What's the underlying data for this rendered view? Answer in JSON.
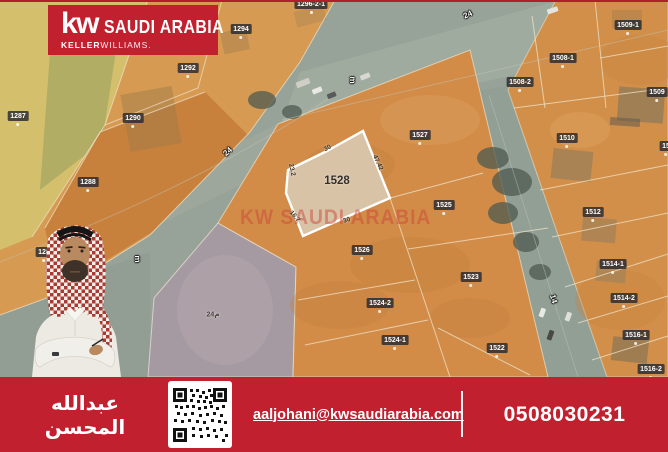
{
  "brand": {
    "kw": "kw",
    "region": "SAUDI ARABIA",
    "keller": "KELLER",
    "williams": "WILLIAMS.",
    "red": "#c1202f"
  },
  "watermark": "KW SAUDI ARABIA",
  "map": {
    "highlight": {
      "label": "1528",
      "fill": "#d8c3a6",
      "dims": [
        {
          "text": "30"
        },
        {
          "text": "47.42"
        },
        {
          "text": "23.2"
        },
        {
          "text": "16.7"
        },
        {
          "text": "30"
        }
      ]
    },
    "plots": [
      {
        "label": "1296-2-1"
      },
      {
        "label": "1294"
      },
      {
        "label": "1292"
      },
      {
        "label": "1290"
      },
      {
        "label": "1287"
      },
      {
        "label": "1288"
      },
      {
        "label": "128"
      },
      {
        "label": "1509-1"
      },
      {
        "label": "1508-1"
      },
      {
        "label": "1508-2"
      },
      {
        "label": "1509"
      },
      {
        "label": "1510"
      },
      {
        "label": "15"
      },
      {
        "label": "1512"
      },
      {
        "label": "1527"
      },
      {
        "label": "1525"
      },
      {
        "label": "1526"
      },
      {
        "label": "1523"
      },
      {
        "label": "1524-2"
      },
      {
        "label": "1524-1"
      },
      {
        "label": "1522"
      },
      {
        "label": "1514-1"
      },
      {
        "label": "1514-2"
      },
      {
        "label": "1516-1"
      },
      {
        "label": "1516-2"
      }
    ],
    "streets": [
      {
        "text": "24"
      },
      {
        "text": "m"
      },
      {
        "text": "24"
      },
      {
        "text": "m"
      },
      {
        "text": "14"
      },
      {
        "text": "24م"
      }
    ],
    "colors": {
      "parcel_orange": "#d28c48",
      "parcel_yellow": "#d4c06c",
      "parcel_olive": "#a9a763",
      "road": "#97a399",
      "dirt_parcel": "#a69aa2"
    }
  },
  "footer": {
    "agent_name": "عبدالله المحسن",
    "email": "aaljohani@kwsaudiarabia.com",
    "phone": "0508030231"
  }
}
